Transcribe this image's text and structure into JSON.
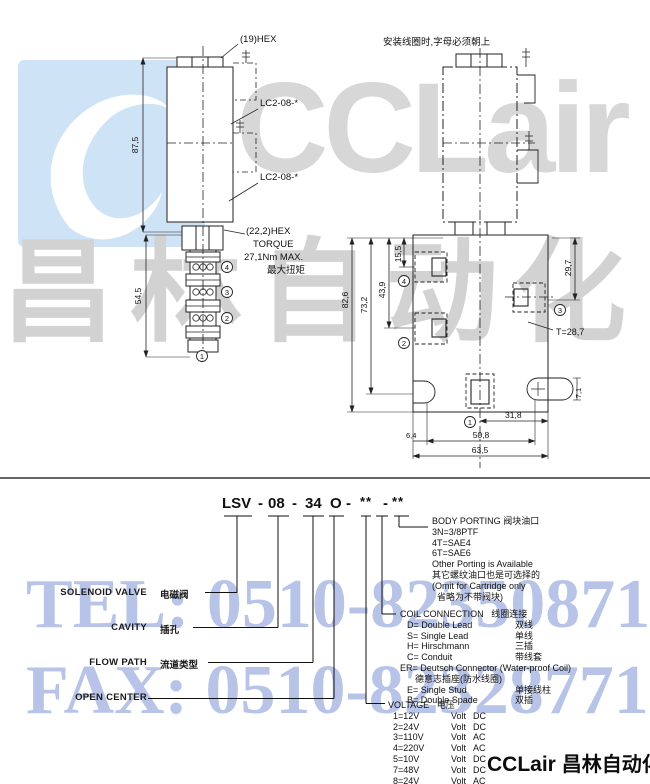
{
  "watermarks": {
    "brand_en": "CCLair",
    "brand_cn": "昌林自动化",
    "tel": "TEL: 0510-82350871",
    "fax": "FAX: 0510-82328771",
    "footer_en": "CCLair",
    "footer_cn": "昌林自动化",
    "colors": {
      "logo_box": "#cfe3f6",
      "brand_gray": "#d7d7d7",
      "phone_blue": "#b7c4e8"
    }
  },
  "left_drawing": {
    "hex_label": "(19)HEX",
    "coupling_label_1": "LC2-08-*",
    "coupling_label_2": "LC2-08-*",
    "coil_height": "87,5",
    "valve_height": "54,5",
    "hex2_label": "(22,2)HEX",
    "torque1": "TORQUE",
    "torque2": "27,1Nm MAX.",
    "torque3": "最大扭矩",
    "port4": "4",
    "port3": "3",
    "port2": "2",
    "port1": "1"
  },
  "right_drawing": {
    "note": "安装线圈时,字母必须朝上",
    "dim_82_6": "82,6",
    "dim_73_2": "73,2",
    "dim_43_9": "43,9",
    "dim_15_5": "15,5",
    "dim_29_7": "29,7",
    "dim_t": "T=28,7",
    "dim_7_1": "7,1",
    "dim_31_8": "31,8",
    "dim_6_4": "6,4",
    "dim_50_8": "50,8",
    "dim_63_5": "63,5",
    "port4": "4",
    "port2": "2",
    "port3": "3",
    "port1": "1"
  },
  "order_code": {
    "parts": [
      "LSV",
      "-",
      "08",
      "-",
      "34",
      "O",
      "-",
      "**",
      "-",
      "**"
    ],
    "labels": {
      "solenoid_en": "SOLENOID VALVE",
      "solenoid_cn": "电磁阀",
      "cavity_en": "CAVITY",
      "cavity_cn": "插孔",
      "flow_en": "FLOW PATH",
      "flow_cn": "流道类型",
      "open_en": "OPEN CENTER"
    },
    "body_porting": {
      "title_en": "BODY PORTING",
      "title_cn": "阀块油口",
      "lines": [
        "3N=3/8PTF",
        "4T=SAE4",
        "6T=SAE6",
        "Other Porting is Available",
        "其它螺纹油口也是可选择的",
        "(Omit for Cartridge only",
        "省略为不带阀块)"
      ]
    },
    "coil_connection": {
      "title_en": "COIL CONNECTION",
      "title_cn": "线圈连接",
      "items": [
        {
          "label": "D= Double Lead",
          "cn": "双线"
        },
        {
          "label": "S= Single Lead",
          "cn": "单线"
        },
        {
          "label": "H= Hirschmann",
          "cn": "三插"
        },
        {
          "label": "C= Conduit",
          "cn": "带线套"
        }
      ],
      "er_label": "ER= Deutsch Connector (Water-proof Coil)",
      "er_cn": "德意志插座(防水线圈)",
      "items2": [
        {
          "label": "E= Single Stud",
          "cn": "单接线柱"
        },
        {
          "label": "B= Double Spade",
          "cn": "双插"
        }
      ]
    },
    "voltage": {
      "title_en": "VOLTAGE",
      "title_cn": "电压",
      "rows": [
        {
          "v": "1=12V",
          "unit": "Volt",
          "cur": "DC"
        },
        {
          "v": "2=24V",
          "unit": "Volt",
          "cur": "DC"
        },
        {
          "v": "3=110V",
          "unit": "Volt",
          "cur": "AC"
        },
        {
          "v": "4=220V",
          "unit": "Volt",
          "cur": "AC"
        },
        {
          "v": "5=10V",
          "unit": "Volt",
          "cur": "DC"
        },
        {
          "v": "7=48V",
          "unit": "Volt",
          "cur": "DC"
        },
        {
          "v": "8=24V",
          "unit": "Volt",
          "cur": "AC"
        }
      ]
    }
  }
}
